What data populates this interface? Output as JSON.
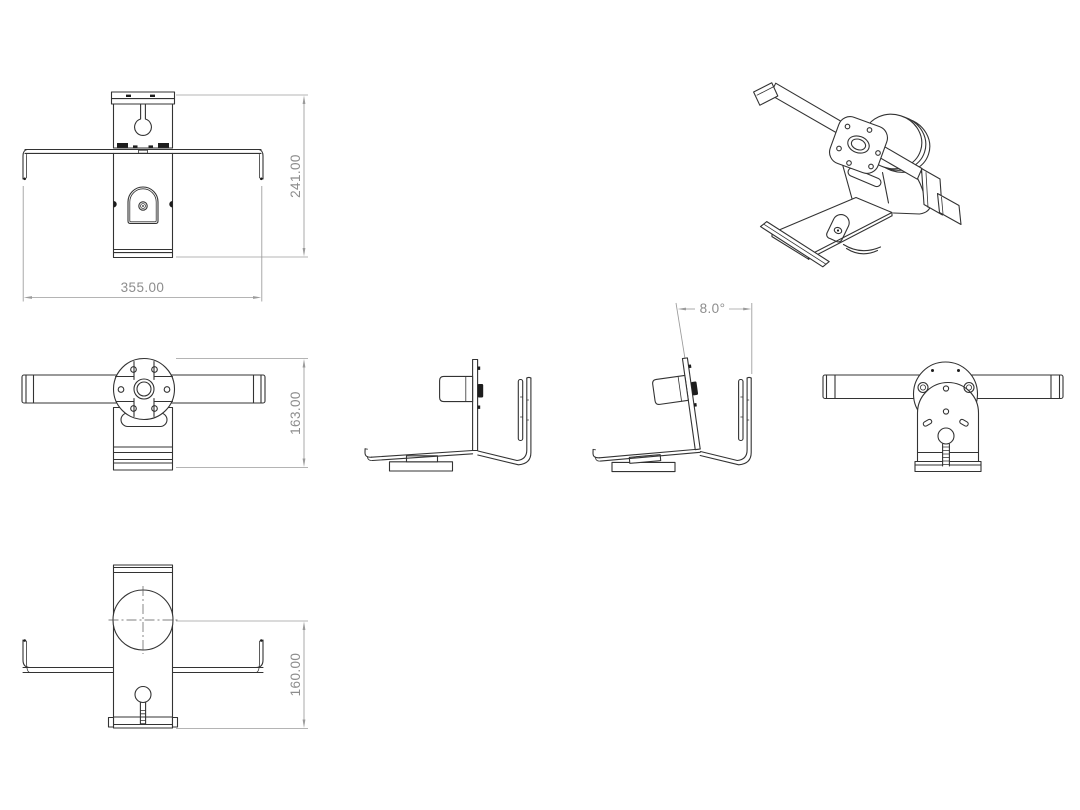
{
  "drawing": {
    "colors": {
      "background": "#ffffff",
      "edges": "#333333",
      "dimensions": "#8d8d8d"
    },
    "dimensions": {
      "front_height": "241.00",
      "front_width": "355.00",
      "rear_height": "163.00",
      "tilt_angle": "8.0°",
      "top_depth": "160.00"
    }
  }
}
